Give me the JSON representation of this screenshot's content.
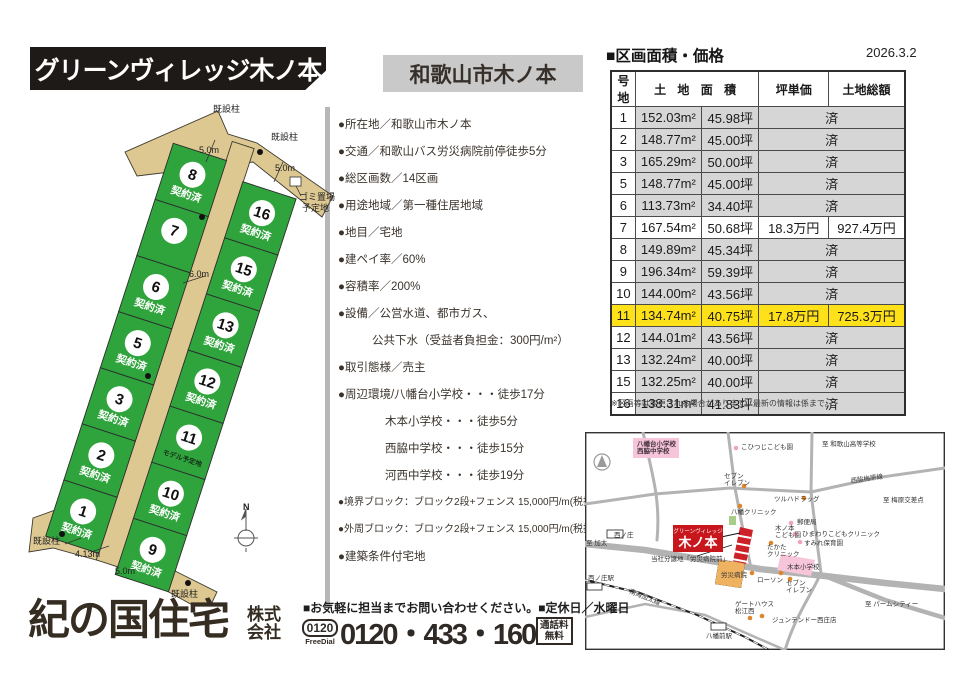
{
  "colors": {
    "lot_green": "#2fa43c",
    "road_tan": "#ddc892",
    "highlight_yellow": "#ffe11a",
    "site_red": "#c8161d",
    "sold_gray": "#d6d6d6"
  },
  "header": {
    "title": "グリーンヴィレッジ木ノ本",
    "subtitle": "和歌山市木ノ本"
  },
  "price": {
    "heading": "■区画面積・価格",
    "date": "2026.3.2",
    "headers": {
      "lot": "号地",
      "area": "土 地 面 積",
      "unit": "坪単価",
      "total": "土地総額"
    },
    "sold_text": "済",
    "rows": [
      {
        "lot": "1",
        "sqm": "152.03m²",
        "tsubo": "45.98坪",
        "sold": true
      },
      {
        "lot": "2",
        "sqm": "148.77m²",
        "tsubo": "45.00坪",
        "sold": true
      },
      {
        "lot": "3",
        "sqm": "165.29m²",
        "tsubo": "50.00坪",
        "sold": true
      },
      {
        "lot": "5",
        "sqm": "148.77m²",
        "tsubo": "45.00坪",
        "sold": true
      },
      {
        "lot": "6",
        "sqm": "113.73m²",
        "tsubo": "34.40坪",
        "sold": true
      },
      {
        "lot": "7",
        "sqm": "167.54m²",
        "tsubo": "50.68坪",
        "sold": false,
        "unit": "18.3万円",
        "total": "927.4万円"
      },
      {
        "lot": "8",
        "sqm": "149.89m²",
        "tsubo": "45.34坪",
        "sold": true
      },
      {
        "lot": "9",
        "sqm": "196.34m²",
        "tsubo": "59.39坪",
        "sold": true
      },
      {
        "lot": "10",
        "sqm": "144.00m²",
        "tsubo": "43.56坪",
        "sold": true
      },
      {
        "lot": "11",
        "sqm": "134.74m²",
        "tsubo": "40.75坪",
        "sold": false,
        "unit": "17.8万円",
        "total": "725.3万円",
        "highlight": true
      },
      {
        "lot": "12",
        "sqm": "144.01m²",
        "tsubo": "43.56坪",
        "sold": true
      },
      {
        "lot": "13",
        "sqm": "132.24m²",
        "tsubo": "40.00坪",
        "sold": true
      },
      {
        "lot": "15",
        "sqm": "132.25m²",
        "tsubo": "40.00坪",
        "sold": true
      },
      {
        "lot": "16",
        "sqm": "138.31m²",
        "tsubo": "41.83坪",
        "sold": true
      }
    ],
    "note": "※区画等は変更される場合があります。最新の情報は係まで。"
  },
  "details": {
    "items": [
      {
        "text": "●所在地／和歌山市木ノ本",
        "indent": 0
      },
      {
        "text": "●交通／和歌山バス労災病院前停徒歩5分",
        "indent": 0
      },
      {
        "text": "●総区画数／14区画",
        "indent": 0
      },
      {
        "text": "●用途地域／第一種住居地域",
        "indent": 0
      },
      {
        "text": "●地目／宅地",
        "indent": 0
      },
      {
        "text": "●建ペイ率／60%",
        "indent": 0
      },
      {
        "text": "●容積率／200%",
        "indent": 0
      },
      {
        "text": "●設備／公営水道、都市ガス、",
        "indent": 0
      },
      {
        "text": "公共下水（受益者負担金：300円/m²）",
        "indent": 1
      },
      {
        "text": "●取引態様／売主",
        "indent": 0
      },
      {
        "text": "●周辺環境/八幡台小学校・・・徒歩17分",
        "indent": 0
      },
      {
        "text": "木本小学校・・・徒歩5分",
        "indent": 2
      },
      {
        "text": "西脇中学校・・・徒歩15分",
        "indent": 2
      },
      {
        "text": "河西中学校・・・徒歩19分",
        "indent": 2
      },
      {
        "text": "●境界ブロック：ブロック2段+フェンス 15,000円/m(税抜)",
        "indent": 0
      },
      {
        "text": "●外周ブロック：ブロック2段+フェンス 15,000円/m(税抜)",
        "indent": 0
      },
      {
        "text": "●建築条件付宅地",
        "indent": 0
      }
    ]
  },
  "site_plan": {
    "left_lots": [
      {
        "no": "8",
        "status": "契約済"
      },
      {
        "no": "7",
        "status": ""
      },
      {
        "no": "6",
        "status": "契約済"
      },
      {
        "no": "5",
        "status": "契約済"
      },
      {
        "no": "3",
        "status": "契約済"
      },
      {
        "no": "2",
        "status": "契約済"
      },
      {
        "no": "1",
        "status": "契約済"
      }
    ],
    "right_lots": [
      {
        "no": "16",
        "status": "契約済"
      },
      {
        "no": "15",
        "status": "契約済"
      },
      {
        "no": "13",
        "status": "契約済"
      },
      {
        "no": "12",
        "status": "契約済"
      },
      {
        "no": "11",
        "status": "モデル予定地"
      },
      {
        "no": "10",
        "status": "契約済"
      },
      {
        "no": "9",
        "status": "契約済"
      }
    ],
    "labels": [
      {
        "t": "既設柱",
        "x": 188,
        "y": 12
      },
      {
        "t": "既設柱",
        "x": 246,
        "y": 40
      },
      {
        "t": "5.0m",
        "x": 174,
        "y": 53
      },
      {
        "t": "5.0m",
        "x": 250,
        "y": 71
      },
      {
        "t": "ゴミ置場",
        "x": 274,
        "y": 100
      },
      {
        "t": "予定地",
        "x": 277,
        "y": 111
      },
      {
        "t": "6.0m",
        "x": 164,
        "y": 177
      },
      {
        "t": "既設柱",
        "x": 8,
        "y": 444
      },
      {
        "t": "4.13m",
        "x": 50,
        "y": 457
      },
      {
        "t": "5.0m",
        "x": 90,
        "y": 474
      },
      {
        "t": "既設柱",
        "x": 146,
        "y": 497
      },
      {
        "t": "N",
        "x": 218,
        "y": 410
      }
    ]
  },
  "map": {
    "site_box": {
      "small": "グリーンヴィレッジ",
      "large": "木ノ本"
    },
    "labels": [
      {
        "lines": [
          "八幡台小学校",
          "西脇中学校"
        ],
        "x": 52,
        "y": 14,
        "cls": "area"
      },
      {
        "lines": [
          "こひつじこども園"
        ],
        "x": 156,
        "y": 17
      },
      {
        "lines": [
          "至 和歌山高等学校"
        ],
        "x": 237,
        "y": 14
      },
      {
        "lines": [
          "セブン",
          "イレブン"
        ],
        "x": 139,
        "y": 46
      },
      {
        "lines": [
          "ツルハドラッグ"
        ],
        "x": 189,
        "y": 69
      },
      {
        "lines": [
          "八幡クリニック"
        ],
        "x": 146,
        "y": 82
      },
      {
        "lines": [
          "西脇梅原線"
        ],
        "x": 266,
        "y": 51,
        "rot": -8
      },
      {
        "lines": [
          "至 梅原交差点"
        ],
        "x": 298,
        "y": 70
      },
      {
        "lines": [
          "郵便局"
        ],
        "x": 212,
        "y": 92
      },
      {
        "lines": [
          "木ノ本",
          "こども園"
        ],
        "x": 190,
        "y": 98
      },
      {
        "lines": [
          "ひまわりこどもクリニック"
        ],
        "x": 217,
        "y": 104
      },
      {
        "lines": [
          "すみれ保育園"
        ],
        "x": 219,
        "y": 113
      },
      {
        "lines": [
          "たかた",
          "クリニック"
        ],
        "x": 182,
        "y": 117
      },
      {
        "lines": [
          "当社分譲地「労災病院前」"
        ],
        "x": 66,
        "y": 129
      },
      {
        "lines": [
          "労災病院"
        ],
        "x": 136,
        "y": 145
      },
      {
        "lines": [
          "ローソン"
        ],
        "x": 172,
        "y": 150
      },
      {
        "lines": [
          "木本小学校"
        ],
        "x": 202,
        "y": 137
      },
      {
        "lines": [
          "セブン",
          "イレブン"
        ],
        "x": 201,
        "y": 153
      },
      {
        "lines": [
          "ゲートハウス",
          "松江西"
        ],
        "x": 150,
        "y": 174
      },
      {
        "lines": [
          "ジュンテンドー西庄店"
        ],
        "x": 187,
        "y": 190
      },
      {
        "lines": [
          "八幡前駅"
        ],
        "x": 121,
        "y": 206
      },
      {
        "lines": [
          "西ノ庄駅"
        ],
        "x": 3,
        "y": 148
      },
      {
        "lines": [
          "南海加太線"
        ],
        "x": 44,
        "y": 161,
        "rot": 22
      },
      {
        "lines": [
          "至 パームシティー"
        ],
        "x": 280,
        "y": 174
      },
      {
        "lines": [
          "西ノ庄"
        ],
        "x": 29,
        "y": 105
      },
      {
        "lines": [
          "至 加太"
        ],
        "x": 1,
        "y": 113
      }
    ]
  },
  "footer": {
    "logo": "紀の国住宅",
    "logo_suffix1": "株式",
    "logo_suffix2": "会社",
    "contact": "■お気軽に担当までお問い合わせください。■定休日／水曜日",
    "freedial_number": "0120",
    "freedial_label": "FreeDial",
    "phone": "0120・433・160",
    "badge_line1": "通話料",
    "badge_line2": "無料"
  }
}
